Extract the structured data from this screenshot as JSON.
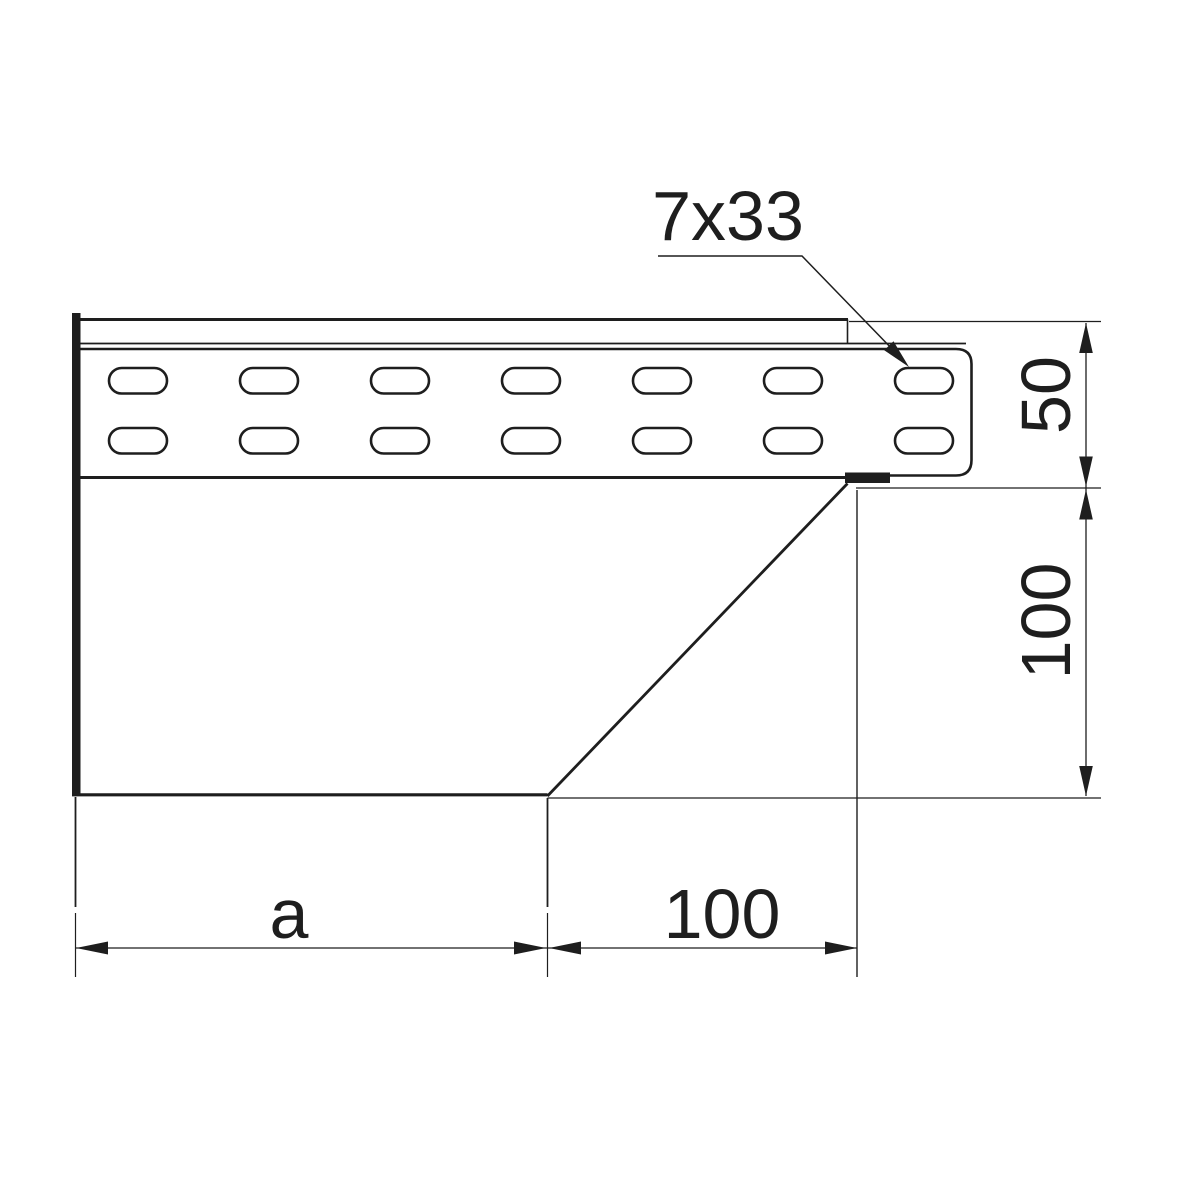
{
  "canvas": {
    "background": "#ffffff",
    "line_color": "#1e1e1e"
  },
  "labels": {
    "slot_size": "7x33",
    "rail_height": "50",
    "body_height": "100",
    "length_a": "a",
    "taper_length": "100"
  }
}
